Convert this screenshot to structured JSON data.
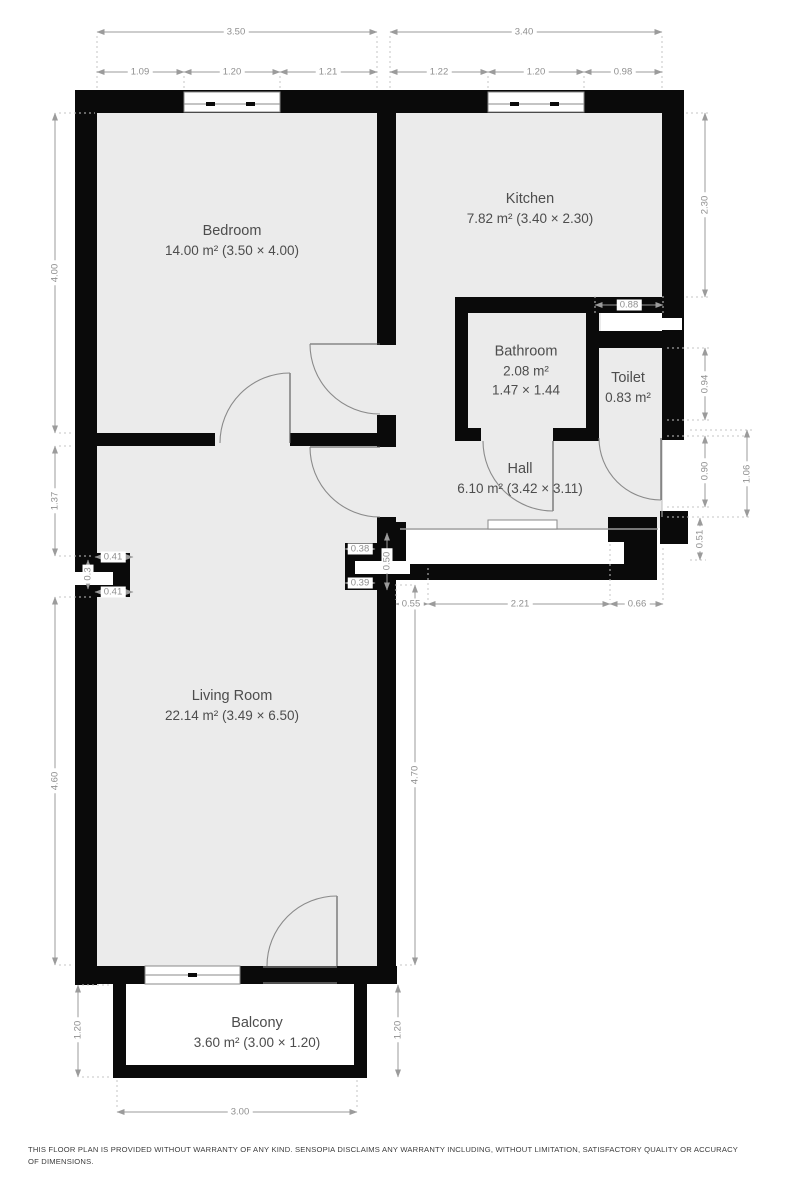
{
  "plan": {
    "rooms": {
      "bedroom": {
        "name": "Bedroom",
        "area": "14.00 m² (3.50 × 4.00)"
      },
      "kitchen": {
        "name": "Kitchen",
        "area": "7.82 m² (3.40 × 2.30)"
      },
      "bathroom": {
        "name": "Bathroom",
        "area": "2.08 m²",
        "size": "1.47 × 1.44"
      },
      "toilet": {
        "name": "Toilet",
        "area": "0.83 m²"
      },
      "hall": {
        "name": "Hall",
        "area": "6.10 m² (3.42 × 3.11)"
      },
      "living": {
        "name": "Living Room",
        "area": "22.14 m² (3.49 × 6.50)"
      },
      "balcony": {
        "name": "Balcony",
        "area": "3.60 m² (3.00 × 1.20)"
      }
    },
    "dims": {
      "top_left_total": "3.50",
      "top_left_1": "1.09",
      "top_left_2": "1.20",
      "top_left_3": "1.21",
      "top_right_total": "3.40",
      "top_right_1": "1.22",
      "top_right_2": "1.20",
      "top_right_3": "0.98",
      "left_bedroom": "4.00",
      "left_mid": "1.37",
      "left_duct_top": "0.41",
      "left_duct_mid": "0.3",
      "left_duct_bottom": "0.41",
      "left_living": "4.60",
      "left_balcony": "1.20",
      "right_kitchen": "2.30",
      "right_duct": "0.88",
      "right_toilet": "0.94",
      "right_niche_inner": "0.90",
      "right_niche_outer": "1.06",
      "right_entry": "0.51",
      "right_living": "4.70",
      "right_balcony": "1.20",
      "center_duct_top": "0.38",
      "center_duct_mid": "0.50",
      "center_duct_bottom": "0.39",
      "entry_left": "0.55",
      "entry_width": "2.21",
      "entry_right": "0.66",
      "balcony_width": "3.00"
    },
    "colors": {
      "wall": "#0a0a0a",
      "floor": "#ebebeb",
      "dimension": "#8f8f8f",
      "label": "#4d4d4d"
    },
    "disclaimer": "THIS FLOOR PLAN IS PROVIDED WITHOUT WARRANTY OF ANY KIND. SENSOPIA DISCLAIMS ANY WARRANTY INCLUDING, WITHOUT LIMITATION, SATISFACTORY QUALITY OR ACCURACY OF DIMENSIONS."
  }
}
